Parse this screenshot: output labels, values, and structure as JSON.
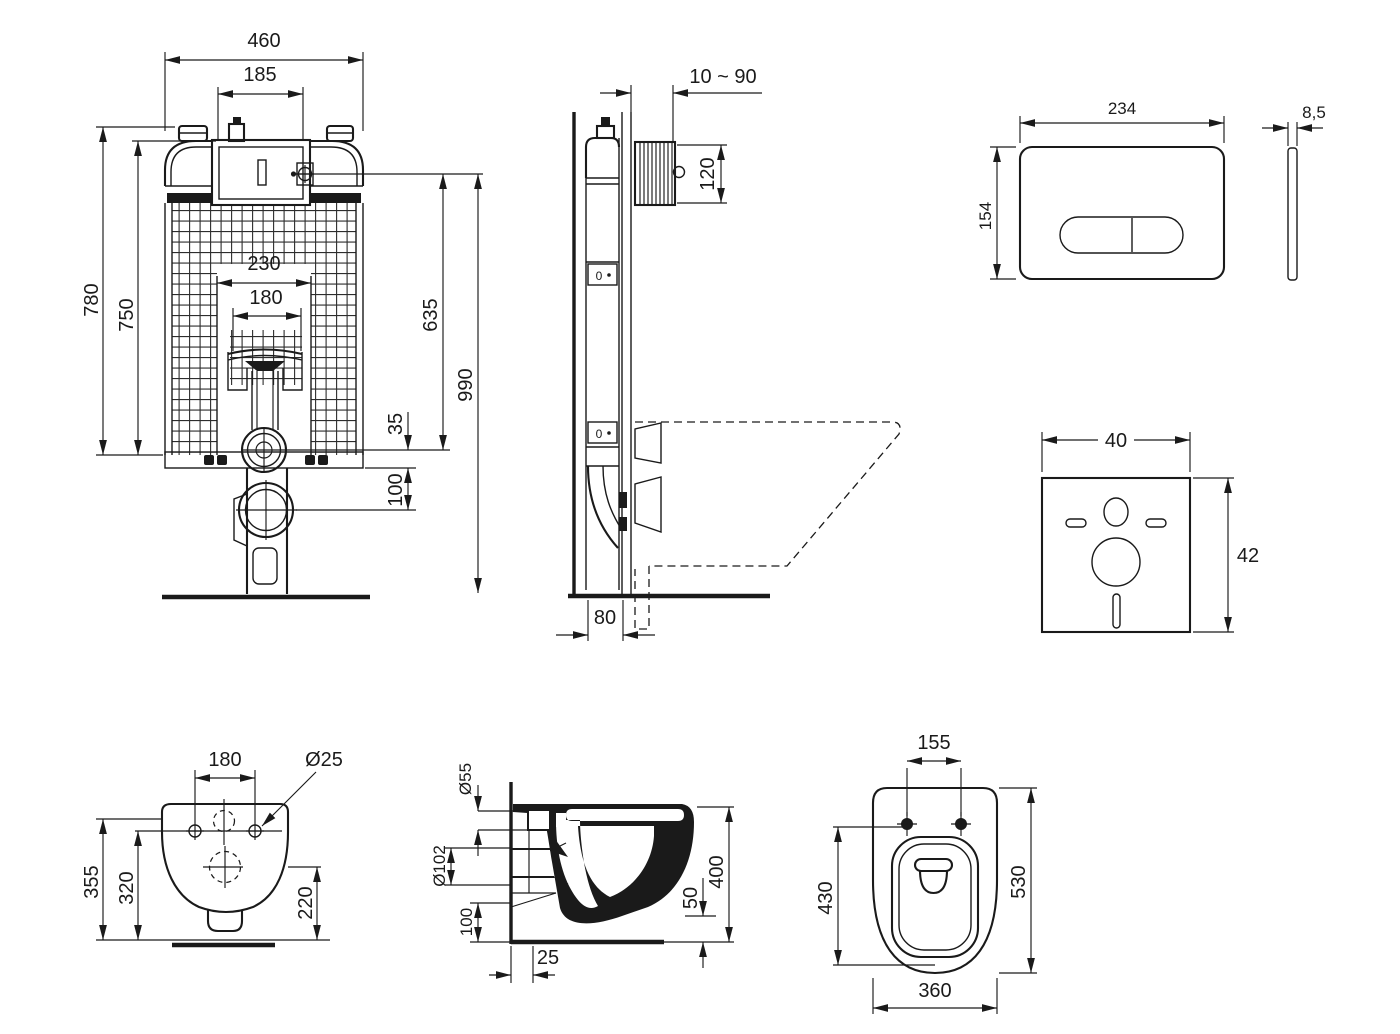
{
  "colors": {
    "background": "#ffffff",
    "ink": "#1a1a1a"
  },
  "views": {
    "cistern_front": {
      "dim_width_total": "460",
      "dim_access_width": "185",
      "dim_height_frame": "780",
      "dim_height_tank": "750",
      "dim_cutout_width": "230",
      "dim_pipe_width": "180",
      "dim_height_inlet_valve": "635",
      "dim_height_total": "990",
      "dim_outlet_offset": "35",
      "dim_outlet_drop": "100"
    },
    "frame_side": {
      "dim_depth_adjust": "10 ~ 90",
      "dim_inlet_height": "120",
      "dim_base_depth": "80",
      "marker": "0"
    },
    "flush_plate": {
      "dim_width": "234",
      "dim_height": "154",
      "dim_thickness": "8,5"
    },
    "sound_mat": {
      "dim_width": "40",
      "dim_height": "42"
    },
    "bowl_rear": {
      "dim_hole_spacing": "180",
      "dim_hole_diameter": "Ø25",
      "dim_height_inlet": "355",
      "dim_height_holes": "320",
      "dim_height_outlet": "220"
    },
    "bowl_side": {
      "dim_inlet_diameter": "Ø55",
      "dim_outlet_diameter": "Ø102",
      "dim_outlet_height": "100",
      "dim_wall_offset": "25",
      "dim_clearance": "50",
      "dim_depth": "400"
    },
    "bowl_top": {
      "dim_hole_spacing": "155",
      "dim_bowl_length": "430",
      "dim_total_length": "530",
      "dim_width": "360"
    }
  }
}
